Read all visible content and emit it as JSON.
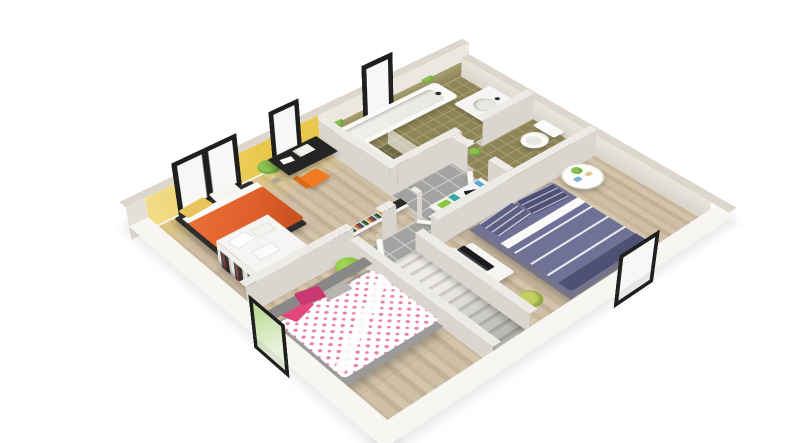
{
  "meta": {
    "type": "3d-floor-plan-render",
    "view": "isometric-top-down",
    "style": "architectural visualization, white background, no text labels"
  },
  "palette": {
    "background": "#ffffff",
    "slab_white": "#f7f6f3",
    "wall_cap": "#dcd6cb",
    "wall_face": "#e4e0d8",
    "wall_base": "#c9c5bd",
    "interior_wall_top": "#edebe6",
    "interior_wall_face": "#dad6cf",
    "wood_a": "#d3c4ac",
    "wood_b": "#c8b79d",
    "wood_c": "#cfbfa6",
    "wood_d": "#c3b196",
    "tile_gray": "#a3a3a1",
    "tile_gray_line": "#c9c9c7",
    "tile_olive": "#8d8457",
    "tile_olive_line": "#a59d6e",
    "tile_olive_dark": "#6f6844",
    "accent_yellow": "#eac84e",
    "accent_yellow_light": "#f3dc8a",
    "window_frame": "#1f1f1d",
    "window_pane": "#f7f7f6",
    "window_green": "#b8d98e",
    "bed_orange": "#e05f2a",
    "bed_orange_dark": "#c44f1f",
    "bed_platform_dark": "#2f2d2b",
    "pillow_yellow": "#e9c35b",
    "polka_pink": "#e87d9f",
    "pillow_pink": "#e2487e",
    "pillow_pink_dark": "#c9386f",
    "bed_gray": "#9d9b99",
    "headboard_gray": "#8a8886",
    "bed_blue": "#6f7296",
    "bed_blue_dark": "#5d5f84",
    "bed_blue_deep": "#4e5076",
    "green_pouf": "#8bc53f",
    "plant_green": "#6fae3e",
    "furniture_white": "#f6f5f3",
    "desk_black": "#242422",
    "chair_orange": "#ee7a22",
    "tub_white": "#fbfbfa",
    "tub_inner": "#e9e7e2",
    "tv_black": "#1c1c1c"
  },
  "rooms": [
    {
      "id": "bedroom-1",
      "floor": "wood-plank",
      "wall_accent": "yellow",
      "contents": [
        "orange-double-bed",
        "yellow-pillow",
        "white-pillow",
        "corner-plant",
        "black-desk",
        "laptop",
        "papers",
        "orange-desk-chair",
        "open-wardrobe-with-clothes",
        "linen-stacks-on-wardrobe",
        "bookshelf-row"
      ]
    },
    {
      "id": "bathroom",
      "floor": "olive-tile",
      "contents": [
        "bathtub",
        "shower-corner",
        "glass-screen",
        "vanity-sink",
        "ledge-plants"
      ]
    },
    {
      "id": "wc",
      "floor": "olive-tile",
      "contents": [
        "toilet",
        "small-plant"
      ]
    },
    {
      "id": "hallway-landing",
      "floor": "gray-tile",
      "contents": [
        "staircase-down",
        "white-console-dresser",
        "decor-items",
        "open-white-doors"
      ]
    },
    {
      "id": "bedroom-2",
      "floor": "wood-plank",
      "contents": [
        "polka-dot-double-bed",
        "gray-headboard",
        "pink-pillows",
        "gray-pillow",
        "green-pouf"
      ]
    },
    {
      "id": "bedroom-3",
      "floor": "wood-plank",
      "contents": [
        "blue-striped-double-bed",
        "striped-pillows",
        "tv-cabinet",
        "flat-tv",
        "round-side-table",
        "corner-plant"
      ]
    }
  ],
  "windows": [
    {
      "id": "window-north-double",
      "wall": "north",
      "panes": 2
    },
    {
      "id": "window-north-desk",
      "wall": "north",
      "panes": 1
    },
    {
      "id": "window-north-bath",
      "wall": "north",
      "panes": 1
    },
    {
      "id": "window-west",
      "wall": "west",
      "panes": 1,
      "view": "green-tree"
    },
    {
      "id": "window-south",
      "wall": "south",
      "panes": 1
    }
  ]
}
